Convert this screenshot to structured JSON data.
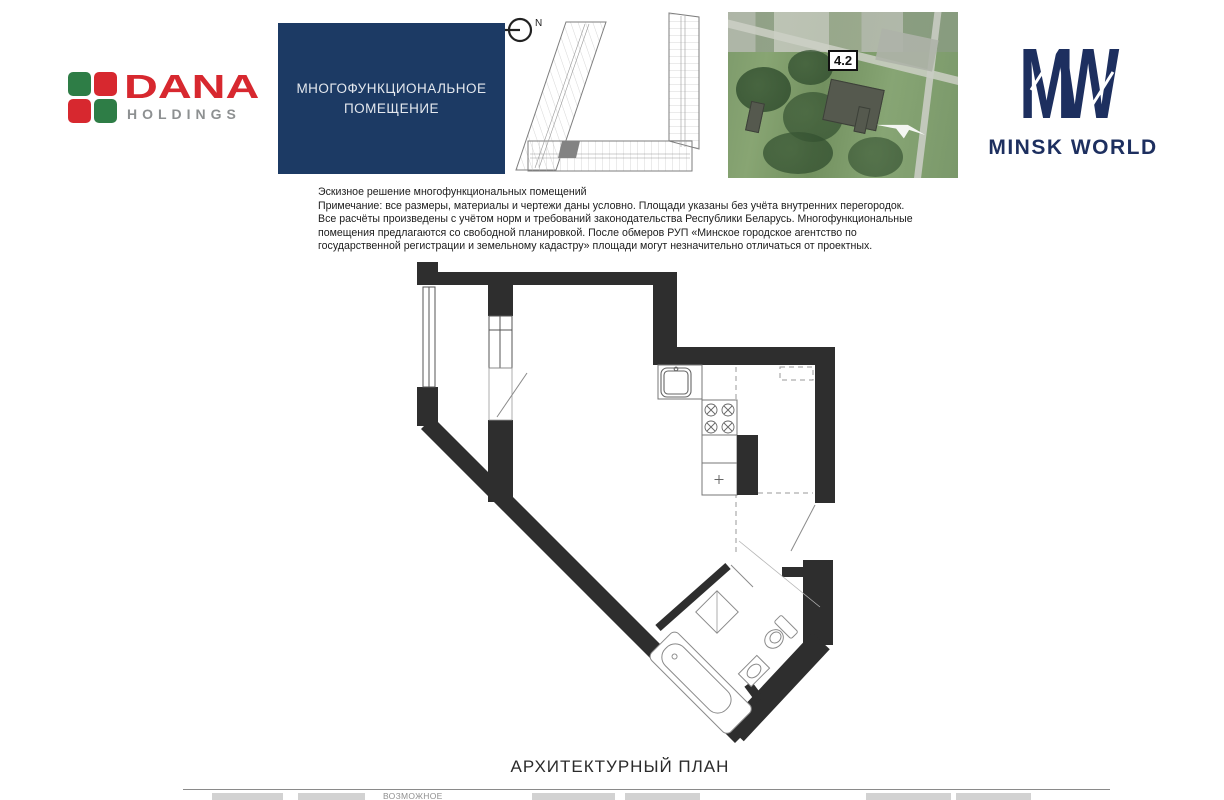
{
  "header": {
    "dana_logo": {
      "title": "DANA",
      "subtitle": "HOLDINGS",
      "red": "#d7282f",
      "green": "#2e7d46",
      "gray": "#8d9091"
    },
    "unit_type_box": {
      "line1": "МНОГОФУНКЦИОНАЛЬНОЕ",
      "line2": "ПОМЕЩЕНИЕ",
      "bg_color": "#1c3a64"
    },
    "key_plan": {
      "north_label": "N"
    },
    "aerial": {
      "building_label": "4.2"
    },
    "minsk_world_logo": {
      "monogram_m": "M",
      "monogram_w": "W",
      "wordmark": "MINSK WORLD",
      "navy": "#1d2f5f"
    }
  },
  "disclaimer": {
    "lines": [
      "Эскизное решение многофункциональных помещений",
      "Примечание: все размеры, материалы и чертежи даны условно. Площади указаны без учёта внутренних перегородок.",
      "Все расчёты произведены с учётом норм и требований законодательства Республики Беларусь. Многофункциональные",
      "помещения предлагаются со свободной планировкой. После обмеров РУП «Минское городское агентство по",
      "государственной регистрации и земельному кадастру» площади могут незначительно отличаться от проектных."
    ]
  },
  "plan": {
    "caption": "АРХИТЕКТУРНЫЙ ПЛАН",
    "wall_color": "#2e2e2e"
  },
  "footer_legend": {
    "visible_label": "ВОЗМОЖНОЕ"
  }
}
